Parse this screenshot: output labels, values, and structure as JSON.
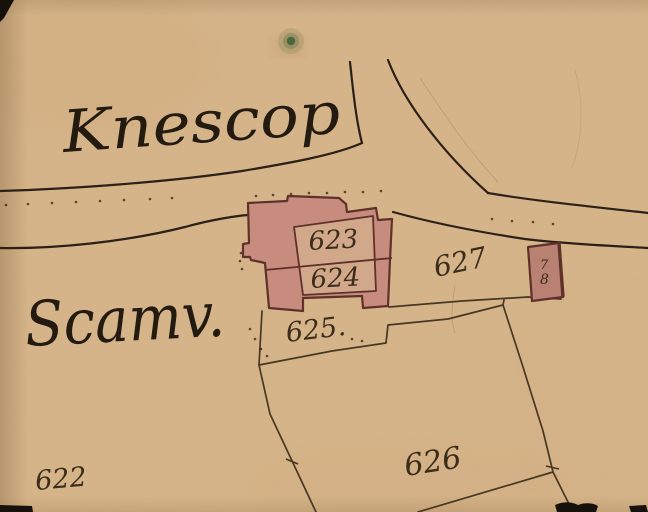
{
  "map": {
    "title": "historical cadastral map fragment",
    "place_names": {
      "knescop": "Knescop",
      "scam": "Scamv."
    },
    "parcel_numbers": {
      "p622": "622",
      "p623": "623",
      "p624": "624",
      "p625": "625.",
      "p626": "626",
      "p627": "627"
    },
    "building_label": {
      "top_digit": "7",
      "bottom_digit": "8"
    },
    "symbols": {
      "tree": "tree-symbol"
    }
  },
  "colors": {
    "paper": "#d7b58a",
    "road_ink": "#2b2118",
    "boundary_ink": "#473823",
    "building_fill": "#c78c7d",
    "courtyard_fill": "#d2a88b",
    "building_outline": "#5e322a",
    "handwriting_ink": "#241b10",
    "number_ink": "#3c2c1a",
    "tree_green": "#47683c",
    "edge_black": "#17110b"
  }
}
